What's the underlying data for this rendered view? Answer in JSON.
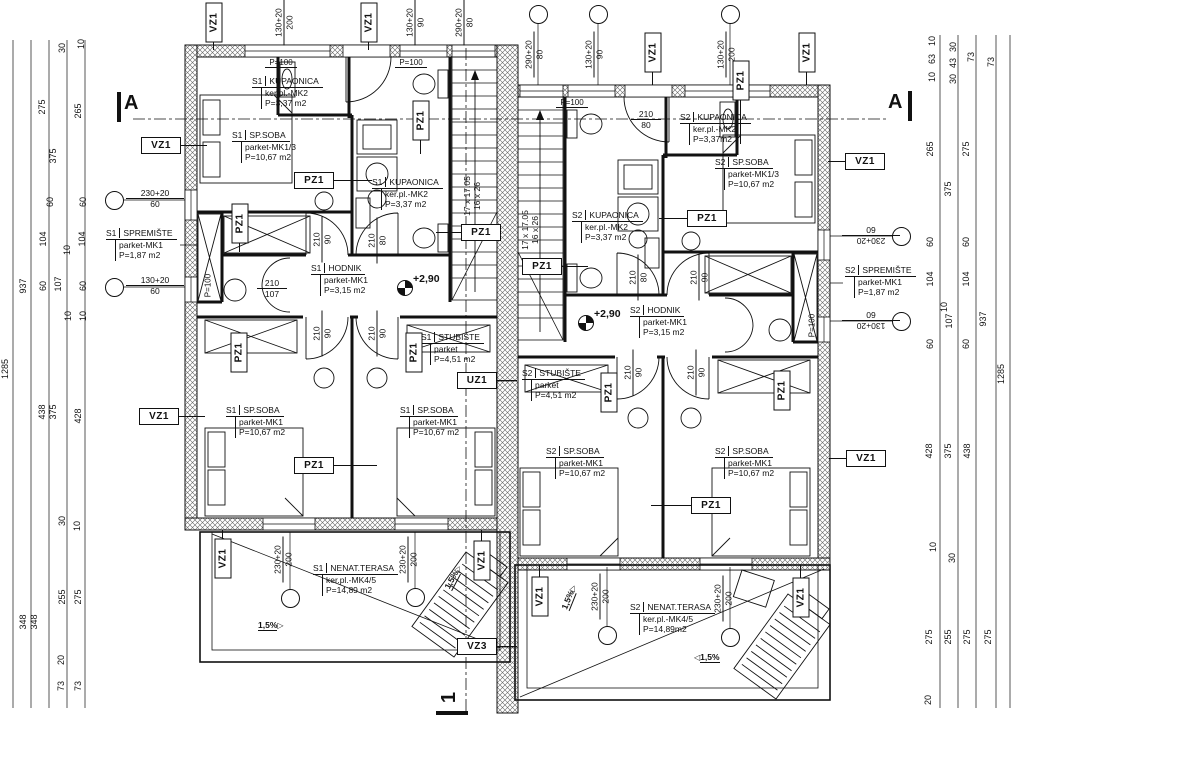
{
  "plan": {
    "style": {
      "ink": "#111111",
      "hatch": "#666666",
      "background": "#ffffff"
    },
    "tags": [
      {
        "t": "VZ1",
        "x": 213,
        "y": 22,
        "v": 1,
        "ld": "down",
        "ln": 9
      },
      {
        "t": "VZ1",
        "x": 368,
        "y": 22,
        "v": 1,
        "ld": "down",
        "ln": 9
      },
      {
        "t": "VZ1",
        "x": 652,
        "y": 52,
        "v": 1,
        "ld": "down",
        "ln": 14
      },
      {
        "t": "VZ1",
        "x": 806,
        "y": 52,
        "v": 1,
        "ld": "down",
        "ln": 14
      },
      {
        "t": "VZ1",
        "x": 160,
        "y": 145,
        "v": 0,
        "ld": "right",
        "ln": 28
      },
      {
        "t": "VZ1",
        "x": 158,
        "y": 416,
        "v": 0,
        "ld": "right",
        "ln": 28
      },
      {
        "t": "VZ1",
        "x": 864,
        "y": 161,
        "v": 0,
        "ld": "left",
        "ln": 17
      },
      {
        "t": "VZ1",
        "x": 865,
        "y": 458,
        "v": 0,
        "ld": "left",
        "ln": 17
      },
      {
        "t": "VZ1",
        "x": 222,
        "y": 558,
        "v": 1,
        "ld": "up",
        "ln": 9
      },
      {
        "t": "VZ1",
        "x": 481,
        "y": 560,
        "v": 1,
        "ld": "up",
        "ln": 11
      },
      {
        "t": "VZ1",
        "x": 539,
        "y": 596,
        "v": 1,
        "ld": "up",
        "ln": 12
      },
      {
        "t": "VZ1",
        "x": 800,
        "y": 597,
        "v": 1,
        "ld": "up",
        "ln": 13
      },
      {
        "t": "PZ1",
        "x": 313,
        "y": 180,
        "v": 0,
        "ld": "right",
        "ln": 40
      },
      {
        "t": "PZ1",
        "x": 420,
        "y": 120,
        "v": 1,
        "ld": "down",
        "ln": 15
      },
      {
        "t": "PZ1",
        "x": 239,
        "y": 223,
        "v": 1,
        "ld": "down",
        "ln": 10
      },
      {
        "t": "PZ1",
        "x": 480,
        "y": 232,
        "v": 0,
        "ld": "left",
        "ln": 25
      },
      {
        "t": "PZ1",
        "x": 238,
        "y": 352,
        "v": 1
      },
      {
        "t": "PZ1",
        "x": 413,
        "y": 352,
        "v": 1
      },
      {
        "t": "PZ1",
        "x": 313,
        "y": 465,
        "v": 0,
        "ld": "right",
        "ln": 45
      },
      {
        "t": "PZ1",
        "x": 740,
        "y": 80,
        "v": 1,
        "ld": "down",
        "ln": 45
      },
      {
        "t": "PZ1",
        "x": 706,
        "y": 218,
        "v": 0,
        "ld": "left",
        "ln": 28
      },
      {
        "t": "PZ1",
        "x": 541,
        "y": 266,
        "v": 0,
        "ld": "right",
        "ln": 28
      },
      {
        "t": "PZ1",
        "x": 781,
        "y": 390,
        "v": 1
      },
      {
        "t": "PZ1",
        "x": 608,
        "y": 392,
        "v": 1
      },
      {
        "t": "PZ1",
        "x": 710,
        "y": 505,
        "v": 0,
        "ld": "left",
        "ln": 40
      },
      {
        "t": "UZ1",
        "x": 476,
        "y": 380,
        "v": 0,
        "ld": "right",
        "ln": 22
      },
      {
        "t": "VZ3",
        "x": 476,
        "y": 646,
        "v": 0,
        "ld": "right",
        "ln": 22
      }
    ],
    "rooms": [
      {
        "u": "S1",
        "n": "KUPAONICA",
        "m": "ker.pl.-MK2",
        "a": "P=3,37  m2",
        "x": 252,
        "y": 76
      },
      {
        "u": "S1",
        "n": "SP.SOBA",
        "m": "parket-MK1/3",
        "a": "P=10,67  m2",
        "x": 232,
        "y": 130
      },
      {
        "u": "S1",
        "n": "KUPAONICA",
        "m": "ker.pl.-MK2",
        "a": "P=3,37  m2",
        "x": 372,
        "y": 177
      },
      {
        "u": "S1",
        "n": "SPREMIŠTE",
        "m": "parket-MK1",
        "a": "P=1,87  m2",
        "x": 106,
        "y": 228
      },
      {
        "u": "S1",
        "n": "HODNIK",
        "m": "parket-MK1",
        "a": "P=3,15  m2",
        "x": 311,
        "y": 263
      },
      {
        "u": "S1",
        "n": "STUBIŠTE",
        "m": "parket",
        "a": "P=4,51  m2",
        "x": 421,
        "y": 332
      },
      {
        "u": "S1",
        "n": "SP.SOBA",
        "m": "parket-MK1",
        "a": "P=10,67  m2",
        "x": 226,
        "y": 405
      },
      {
        "u": "S1",
        "n": "SP.SOBA",
        "m": "parket-MK1",
        "a": "P=10,67  m2",
        "x": 400,
        "y": 405
      },
      {
        "u": "S1",
        "n": "NENAT.TERASA",
        "m": "ker.pl.-MK4/5",
        "a": "P=14,89  m2",
        "x": 313,
        "y": 563
      },
      {
        "u": "S2",
        "n": "KUPAONICA",
        "m": "ker.pl.-MK2",
        "a": "P=3,37m2",
        "x": 680,
        "y": 112
      },
      {
        "u": "S2",
        "n": "SP.SOBA",
        "m": "parket-MK1/3",
        "a": "P=10,67  m2",
        "x": 715,
        "y": 157
      },
      {
        "u": "S2",
        "n": "KUPAONICA",
        "m": "ker.pl.-MK2",
        "a": "P=3,37  m2",
        "x": 572,
        "y": 210
      },
      {
        "u": "S2",
        "n": "HODNIK",
        "m": "parket-MK1",
        "a": "P=3,15  m2",
        "x": 630,
        "y": 305
      },
      {
        "u": "S2",
        "n": "STUBIŠTE",
        "m": "parket",
        "a": "P=4,51  m2",
        "x": 522,
        "y": 368
      },
      {
        "u": "S2",
        "n": "SP.SOBA",
        "m": "parket-MK1",
        "a": "P=10,67  m2",
        "x": 546,
        "y": 446
      },
      {
        "u": "S2",
        "n": "SP.SOBA",
        "m": "parket-MK1",
        "a": "P=10,67  m2",
        "x": 715,
        "y": 446
      },
      {
        "u": "S2",
        "n": "SPREMIŠTE",
        "m": "parket-MK1",
        "a": "P=1,87  m2",
        "x": 845,
        "y": 265
      },
      {
        "u": "S2",
        "n": "NENAT.TERASA",
        "m": "ker.pl.-MK4/5",
        "a": "P=14,89m2",
        "x": 630,
        "y": 602
      }
    ],
    "bubbles": [
      {
        "l1": "130+20",
        "l2": "200",
        "x": 284,
        "y": 23,
        "o": "v"
      },
      {
        "l1": "130+20",
        "l2": "90",
        "x": 415,
        "y": 23,
        "o": "v"
      },
      {
        "l1": "290+20",
        "l2": "80",
        "x": 464,
        "y": 23,
        "o": "v"
      },
      {
        "l1": "290+20",
        "l2": "80",
        "x": 534,
        "y": 55,
        "o": "v",
        "cx": 538,
        "cy": 14
      },
      {
        "l1": "130+20",
        "l2": "90",
        "x": 594,
        "y": 55,
        "o": "v",
        "cx": 598,
        "cy": 14
      },
      {
        "l1": "130+20",
        "l2": "200",
        "x": 726,
        "y": 55,
        "o": "v",
        "cx": 730,
        "cy": 14
      },
      {
        "l1": "230+20",
        "l2": "60",
        "x": 155,
        "y": 199,
        "o": "h",
        "w": 58,
        "cx": 114,
        "cy": 200
      },
      {
        "l1": "130+20",
        "l2": "60",
        "x": 155,
        "y": 286,
        "o": "h",
        "w": 58,
        "cx": 114,
        "cy": 287
      },
      {
        "l1": "230+20",
        "l2": "60",
        "x": 871,
        "y": 236,
        "o": "r",
        "w": 58,
        "cx": 901,
        "cy": 236
      },
      {
        "l1": "130+20",
        "l2": "60",
        "x": 871,
        "y": 321,
        "o": "r",
        "w": 58,
        "cx": 901,
        "cy": 321
      },
      {
        "l1": "230+20",
        "l2": "200",
        "x": 283,
        "y": 560,
        "o": "v",
        "cx": 290,
        "cy": 598
      },
      {
        "l1": "230+20",
        "l2": "200",
        "x": 408,
        "y": 560,
        "o": "v",
        "cx": 415,
        "cy": 597
      },
      {
        "l1": "230+20",
        "l2": "200",
        "x": 600,
        "y": 597,
        "o": "v",
        "cx": 607,
        "cy": 635
      },
      {
        "l1": "230+20",
        "l2": "200",
        "x": 723,
        "y": 599,
        "o": "v",
        "cx": 730,
        "cy": 637
      }
    ],
    "pairs": [
      {
        "l1": "210",
        "l2": "90",
        "x": 322,
        "y": 240,
        "o": "v"
      },
      {
        "l1": "210",
        "l2": "80",
        "x": 377,
        "y": 241,
        "o": "v"
      },
      {
        "l1": "210",
        "l2": "90",
        "x": 322,
        "y": 334,
        "o": "v"
      },
      {
        "l1": "210",
        "l2": "90",
        "x": 377,
        "y": 334,
        "o": "v"
      },
      {
        "l1": "210",
        "l2": "107",
        "x": 272,
        "y": 289,
        "o": "h",
        "w": 30
      },
      {
        "l1": "210",
        "l2": "80",
        "x": 646,
        "y": 120,
        "o": "h",
        "w": 30
      },
      {
        "l1": "210",
        "l2": "80",
        "x": 638,
        "y": 278,
        "o": "v"
      },
      {
        "l1": "210",
        "l2": "90",
        "x": 699,
        "y": 278,
        "o": "v"
      },
      {
        "l1": "210",
        "l2": "90",
        "x": 633,
        "y": 373,
        "o": "v"
      },
      {
        "l1": "210",
        "l2": "90",
        "x": 696,
        "y": 373,
        "o": "v"
      }
    ],
    "notes": [
      {
        "l1": "17 x 17.05",
        "l2": "16 x 26",
        "x": 472,
        "y": 197,
        "o": "v",
        "w": 54,
        "sep": 0
      },
      {
        "l1": "17 x 17.05",
        "l2": "16 x 26",
        "x": 530,
        "y": 231,
        "o": "v",
        "w": 54,
        "sep": 0
      }
    ],
    "plabels": [
      {
        "t": "P=100",
        "x": 281,
        "y": 63,
        "v": 0
      },
      {
        "t": "P=100",
        "x": 411,
        "y": 63,
        "v": 0
      },
      {
        "t": "P=100",
        "x": 572,
        "y": 103,
        "v": 0
      },
      {
        "t": "P=100",
        "x": 208,
        "y": 286,
        "v": 1
      },
      {
        "t": "P=100",
        "x": 812,
        "y": 326,
        "v": 1
      }
    ],
    "levels": [
      {
        "t": "+2,90",
        "x": 404,
        "y": 287
      },
      {
        "t": "+2,90",
        "x": 585,
        "y": 322
      }
    ],
    "slopes": [
      {
        "t": "1,5%",
        "x": 258,
        "y": 620,
        "r": 0,
        "d": "r"
      },
      {
        "t": "1,5%",
        "x": 440,
        "y": 572,
        "r": -62,
        "d": "r"
      },
      {
        "t": "1,5%",
        "x": 556,
        "y": 592,
        "r": -68,
        "d": "r"
      },
      {
        "t": "1,5%",
        "x": 694,
        "y": 652,
        "r": 0,
        "d": "l"
      }
    ],
    "sections": [
      {
        "t": "A",
        "x": 124,
        "y": 92,
        "r": 0,
        "bar": [
          117,
          92,
          4,
          30
        ]
      },
      {
        "t": "A",
        "x": 888,
        "y": 91,
        "r": 0,
        "bar": [
          908,
          91,
          4,
          30
        ]
      },
      {
        "t": "1",
        "x": 444,
        "y": 686,
        "r": -90,
        "bar": [
          436,
          711,
          32,
          4
        ]
      }
    ],
    "dims": [
      [
        5,
        370,
        "1285"
      ],
      [
        23,
        287,
        "937"
      ],
      [
        23,
        623,
        "348"
      ],
      [
        34,
        623,
        "348"
      ],
      [
        42,
        108,
        "275"
      ],
      [
        53,
        157,
        "375"
      ],
      [
        62,
        49,
        "30"
      ],
      [
        81,
        45,
        "10"
      ],
      [
        78,
        112,
        "265"
      ],
      [
        50,
        203,
        "60"
      ],
      [
        83,
        203,
        "60"
      ],
      [
        43,
        240,
        "104"
      ],
      [
        82,
        240,
        "104"
      ],
      [
        67,
        251,
        "10"
      ],
      [
        58,
        285,
        "107"
      ],
      [
        43,
        287,
        "60"
      ],
      [
        83,
        287,
        "60"
      ],
      [
        68,
        317,
        "10"
      ],
      [
        83,
        317,
        "10"
      ],
      [
        42,
        413,
        "438"
      ],
      [
        53,
        413,
        "375"
      ],
      [
        78,
        417,
        "428"
      ],
      [
        62,
        522,
        "30"
      ],
      [
        77,
        527,
        "10"
      ],
      [
        62,
        598,
        "255"
      ],
      [
        78,
        598,
        "275"
      ],
      [
        61,
        661,
        "20"
      ],
      [
        61,
        687,
        "73"
      ],
      [
        78,
        687,
        "73"
      ],
      [
        932,
        42,
        "10"
      ],
      [
        932,
        60,
        "63"
      ],
      [
        932,
        78,
        "10"
      ],
      [
        953,
        48,
        "30"
      ],
      [
        953,
        64,
        "43"
      ],
      [
        953,
        80,
        "30"
      ],
      [
        971,
        58,
        "73"
      ],
      [
        991,
        63,
        "73"
      ],
      [
        930,
        150,
        "265"
      ],
      [
        966,
        150,
        "275"
      ],
      [
        948,
        190,
        "375"
      ],
      [
        930,
        243,
        "60"
      ],
      [
        966,
        243,
        "60"
      ],
      [
        930,
        280,
        "104"
      ],
      [
        966,
        280,
        "104"
      ],
      [
        944,
        308,
        "10"
      ],
      [
        949,
        322,
        "107"
      ],
      [
        930,
        345,
        "60"
      ],
      [
        966,
        345,
        "60"
      ],
      [
        983,
        320,
        "937"
      ],
      [
        929,
        452,
        "428"
      ],
      [
        948,
        452,
        "375"
      ],
      [
        967,
        452,
        "438"
      ],
      [
        933,
        548,
        "10"
      ],
      [
        952,
        559,
        "30"
      ],
      [
        929,
        638,
        "275"
      ],
      [
        948,
        638,
        "255"
      ],
      [
        967,
        638,
        "275"
      ],
      [
        988,
        638,
        "275"
      ],
      [
        928,
        701,
        "20"
      ],
      [
        1001,
        375,
        "1285"
      ]
    ]
  }
}
